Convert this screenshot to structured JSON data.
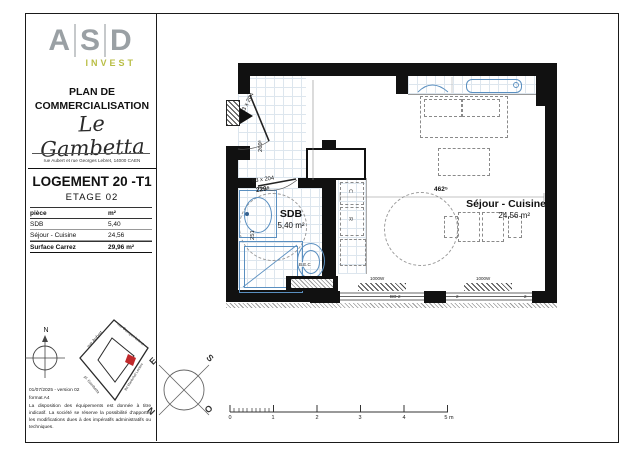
{
  "panel": {
    "logo": {
      "l1": "A",
      "l2": "S",
      "l3": "D",
      "sub": "INVEST"
    },
    "title_line1": "PLAN DE",
    "title_line2": "COMMERCIALISATION",
    "residence": "Le Gambetta",
    "address": "rue Aubert et rue Georges Lebret, 14000 CAEN",
    "unit_title": "LOGEMENT 20 -T1",
    "floor": "ETAGE 02",
    "table": {
      "header_piece": "pièce",
      "header_unit": "m²",
      "rows": [
        {
          "piece": "SDB",
          "surface": "5,40"
        },
        {
          "piece": "Séjour - Cuisine",
          "surface": "24,56"
        }
      ],
      "total_label": "Surface Carrez",
      "total_value": "29,96 m²"
    },
    "compass_n": "N",
    "sitemap": {
      "streets": [
        "rue Aubert",
        "rue Georges Lebret",
        "pl. Gambetta",
        "Bd Maréchal Leclerc"
      ],
      "marker_color": "#c0292b"
    },
    "version": "01/07/2025 - version 02",
    "format": "format A4",
    "disclaimer": "La disposition des équipements est donnée à titre indicatif. La société se réserve la possibilité d'apporter les modifications dues à des impératifs administratifs ou techniques."
  },
  "plan": {
    "rooms": [
      {
        "name": "SDB",
        "area": "5,40 m²"
      },
      {
        "name": "Séjour - Cuisine",
        "area": "24,56 m²"
      }
    ],
    "dims": {
      "entry_door": "93 x 204",
      "entry_height": "269⁵",
      "sdb_door": "83 x 204",
      "sdb_door_dim": "229⁵",
      "sdb_depth": "251",
      "sejour_width": "462⁵"
    },
    "labels": {
      "wc": "B.E.C",
      "cook": "C",
      "fridge": "R",
      "rad": "1000W",
      "win1": "BO-2",
      "win2": "2",
      "win3": "2"
    }
  },
  "compass": {
    "e": "E",
    "s": "S",
    "n": "N",
    "o": "O"
  },
  "scale": {
    "labels": [
      "0",
      "1",
      "2",
      "3",
      "4",
      "5 m"
    ]
  },
  "colors": {
    "accent": "#b9be45",
    "fixture_blue": "#5a8fc0",
    "marker_red": "#c0292b"
  }
}
